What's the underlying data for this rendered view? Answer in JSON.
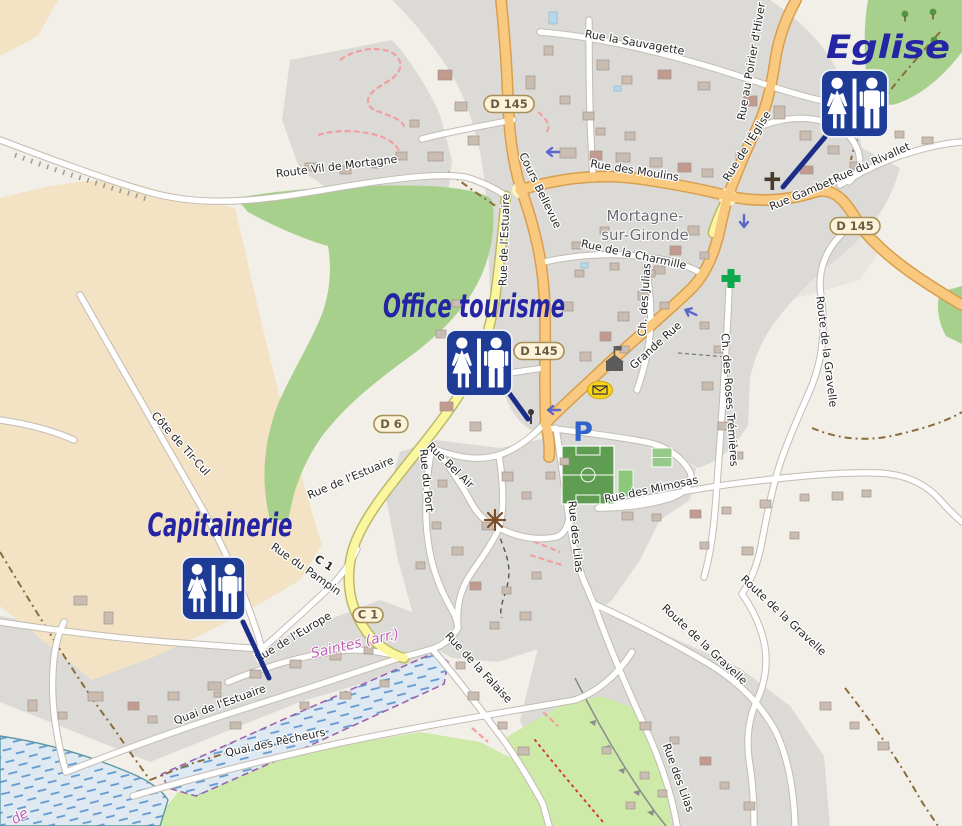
{
  "map_title": "Plan de Mortagne-sur-Gironde avec emplacement des toilettes publiques",
  "annotations": {
    "eglise": "Eglise",
    "office_tourisme": "Office tourisme",
    "capitainerie": "Capitainerie"
  },
  "place_label": {
    "line1": "Mortagne-",
    "line2": "sur-Gironde"
  },
  "admin_labels": {
    "saintes": "Saintes (arr.)",
    "fragment_de": "de"
  },
  "road_refs": {
    "d145_top": "D 145",
    "d145_mid": "D 145",
    "d145_east": "D 145",
    "d6": "D 6",
    "c1_badge": "C 1"
  },
  "poi": {
    "parking_letter": "P"
  },
  "streets": {
    "route_vil_de_mortagne": "Route Vil de Mortagne",
    "rue_la_sauvagette": "Rue la Sauvagette",
    "rue_des_moulins": "Rue des Moulins",
    "cours_bellevue": "Cours Bellevue",
    "rue_de_l_estuaire": "Rue de l'Estuaire",
    "rue_de_l_estuaire_2": "Rue de l'Estuaire",
    "cote_de_tir_cul": "Côte de Tir-Cul",
    "rue_de_l_eglise": "Rue de l'Église",
    "rue_au_poirier_d_hiver": "Rue au Poirier d'Hiver",
    "rue_gambetta": "Rue Gambetta",
    "rue_du_rivallet": "Rue du Rivallet",
    "rue_de_la_charmille": "Rue de la Charmille",
    "ch_des_julias": "Ch. des Julias",
    "grande_rue": "Grande Rue",
    "ch_des_roses_tremieres": "Ch. des Roses Trémières",
    "route_de_la_gravelle": "Route de la Gravelle",
    "route_de_la_gravelle_2": "Route de la Gravelle",
    "route_de_la_gravelle_3": "Route de la Gravelle",
    "rue_des_mimosas": "Rue des Mimosas",
    "rue_bel_air": "Rue Bel Air",
    "rue_du_port": "Rue du Port",
    "rue_des_lilas": "Rue des Lilas",
    "rue_des_lilas_2": "Rue des Lilas",
    "rue_du_pampin": "Rue du Pampin",
    "c1_on_road": "C 1",
    "rue_de_l_europe": "Rue de l'Europe",
    "quai_de_l_estuaire": "Quai de l'Estuaire",
    "quai_des_pecheurs": "Quai des Pêcheurs",
    "rue_de_la_falaise": "Rue de la Falaise"
  },
  "colors": {
    "annotation_text": "#2424a4",
    "wc_icon_blue": "#1e3c96",
    "leader_line": "#1b2d87",
    "road_main_orange": "#f8c97e",
    "road_yellow": "#fbf7a0",
    "urban_gray": "#dbdad6",
    "farmland_tan": "#f3e3c4",
    "scrub_green": "#a6d08c",
    "park_green": "#cdeaa9",
    "water_hatch_blue": "#5f97cf",
    "boundary_purple": "#9a63ad",
    "ref_badge_fill": "#fcf3da",
    "parking_blue": "#2f63c8",
    "pharmacy_green": "#0ea84f",
    "post_yellow": "#f8d31c",
    "background_beige": "#f2efe9"
  }
}
